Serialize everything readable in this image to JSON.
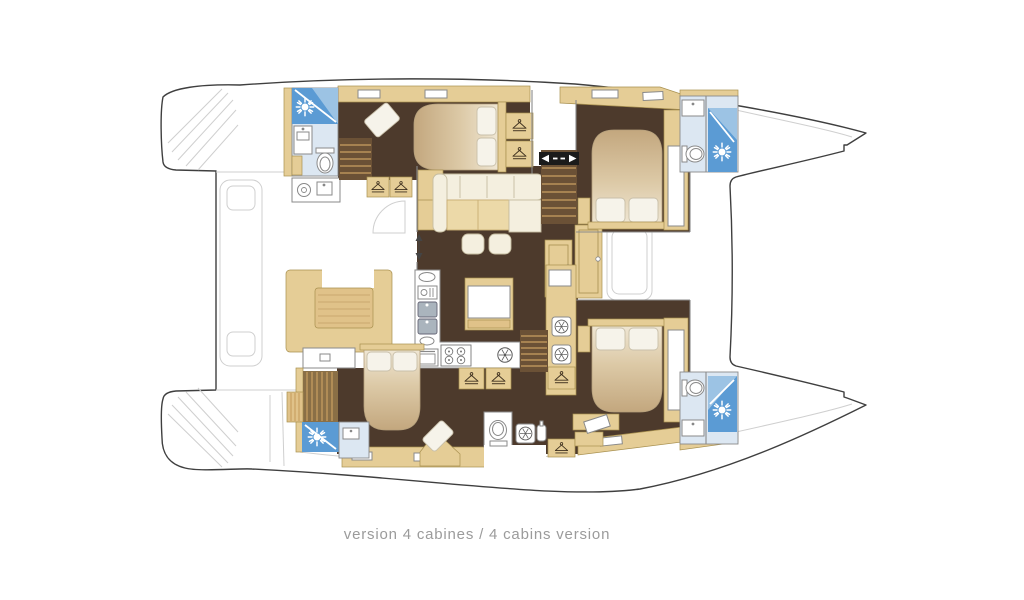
{
  "caption": {
    "text": "version 4 cabines / 4 cabins version"
  },
  "icons": {
    "sun_shower": "sunburst-in-blue-shower-tile",
    "hanger": "coat-hanger-wardrobe",
    "porthole": "spoked-circle",
    "companionway": "black-bar-left-right-arrows",
    "sliding_door": "vertical-double-arrow"
  },
  "theme": {
    "background": "#ffffff",
    "hull_outline": "#3f3f3f",
    "faint_line": "#cfcfcf",
    "wall_line": "#8a8a8a",
    "wood_beige": "#e5cd96",
    "wood_beige_border": "#a8904f",
    "wood_tan": "#e0c289",
    "floor_dark_brown": "#4d3a2c",
    "stair_brown": "#6b5136",
    "stair_step": "#c9a162",
    "sofa_cream": "#f4efdf",
    "cushion_tan": "#ecd9a8",
    "pillow_white": "#f6f3ea",
    "shower_blue": "#5b9bd4",
    "shower_blue_light": "#9cc3e4",
    "bath_floor": "#dce7f2",
    "fixture_outline": "#8a8a8a",
    "marker_black": "#1b1b1b",
    "caption_gray": "#9b9b9b"
  }
}
